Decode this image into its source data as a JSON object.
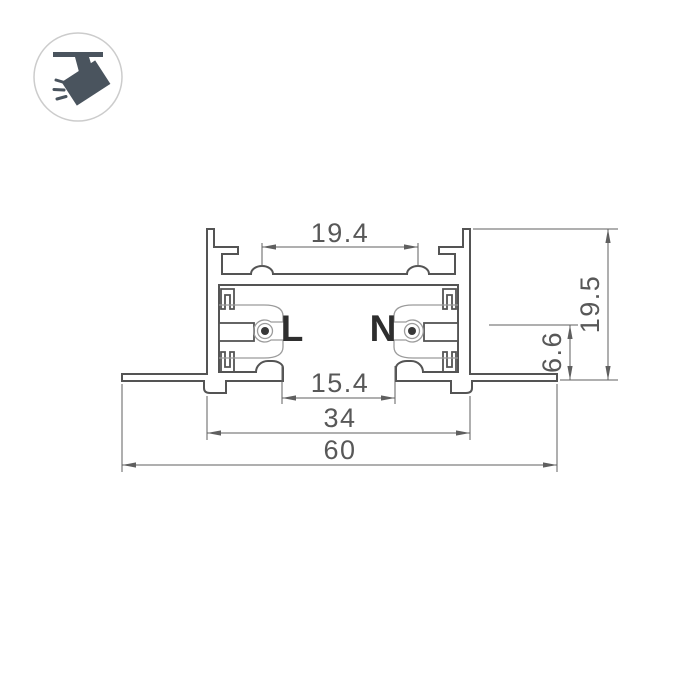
{
  "canvas": {
    "width": 700,
    "height": 700,
    "background": "#ffffff"
  },
  "thumbnail": {
    "icon": "track-spotlight",
    "border_color": "#cccccc",
    "glyph_color": "#4a545e"
  },
  "drawing": {
    "type": "track-profile-cross-section",
    "conductor_labels": {
      "line": "L",
      "neutral": "N"
    },
    "dimensions": {
      "slot_pitch": "19.4",
      "overall_height": "19.5",
      "contact_axis_height": "6.6",
      "aperture_width": "15.4",
      "body_width": "34",
      "overall_width": "60"
    },
    "colors": {
      "profile_stroke": "#545454",
      "insert_stroke": "#9b9b9b",
      "dimension_stroke": "#5f5f5f",
      "dimension_text": "#585858",
      "label_color": "#2e2e2e",
      "contact_dot": "#383838"
    }
  }
}
